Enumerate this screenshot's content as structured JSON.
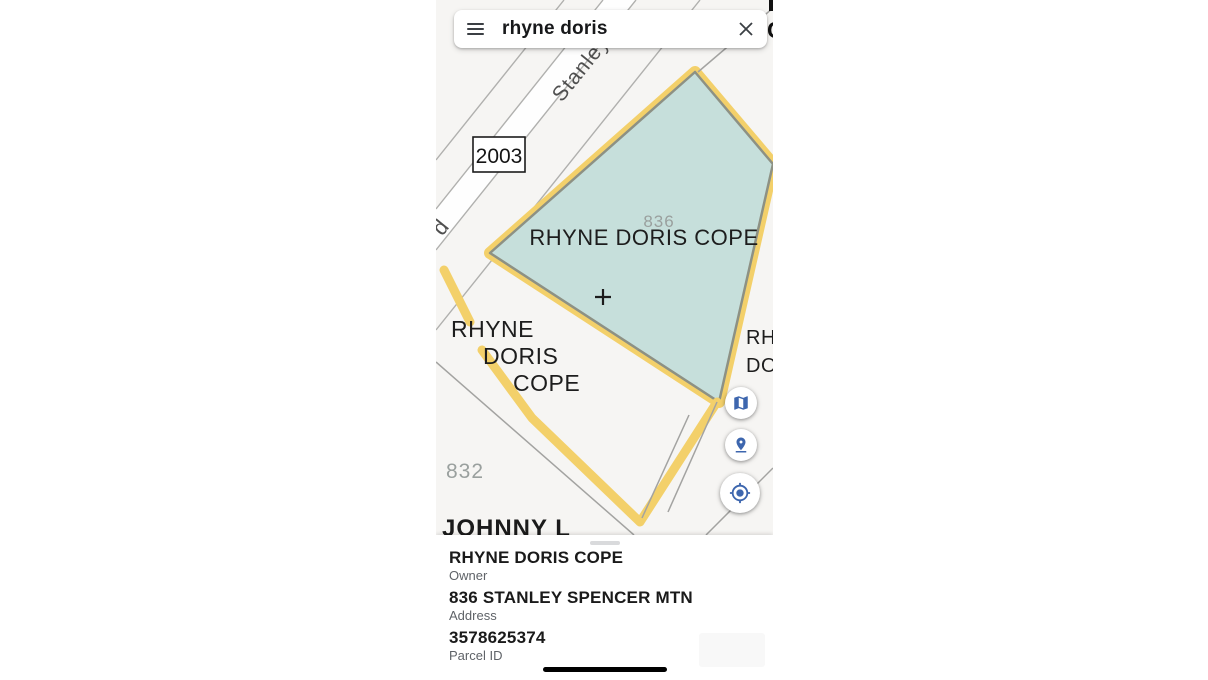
{
  "search": {
    "query": "rhyne doris",
    "menu_icon": "hamburger-menu",
    "clear_icon": "close-x"
  },
  "map": {
    "street": "Stanley",
    "street_fragment": "d",
    "address_box": "2003",
    "selected_parcel": {
      "number": "836",
      "owner": "RHYNE DORIS COPE"
    },
    "left_parcel": {
      "line1": "RHYNE",
      "line2": "DORIS",
      "line3": "COPE"
    },
    "parcel_832": "832",
    "bottom_parcel": "JOHNNY L",
    "right_edge_parcel": {
      "line1": "RH",
      "line2": "DO"
    },
    "top_edge_fragment": "C",
    "center_marker": "+",
    "colors": {
      "selected_fill": "#c6dfdb",
      "highlight": "#f3d06a",
      "selected_boundary": "#8d9184",
      "parcel_line": "#a3a3a1",
      "road_line": "#b0b0ae",
      "muted_label": "#9aa09e",
      "control_icon": "#3d66ae",
      "map_background": "#f6f5f3"
    }
  },
  "controls": {
    "layers_button_icon": "map-layers",
    "pin_button_icon": "pin-drop",
    "locate_button_icon": "my-location"
  },
  "bottom_sheet": {
    "rows": [
      {
        "value": "RHYNE DORIS COPE",
        "label": "Owner"
      },
      {
        "value": "836 STANLEY SPENCER MTN",
        "label": "Address"
      },
      {
        "value": "3578625374",
        "label": "Parcel ID"
      }
    ]
  }
}
